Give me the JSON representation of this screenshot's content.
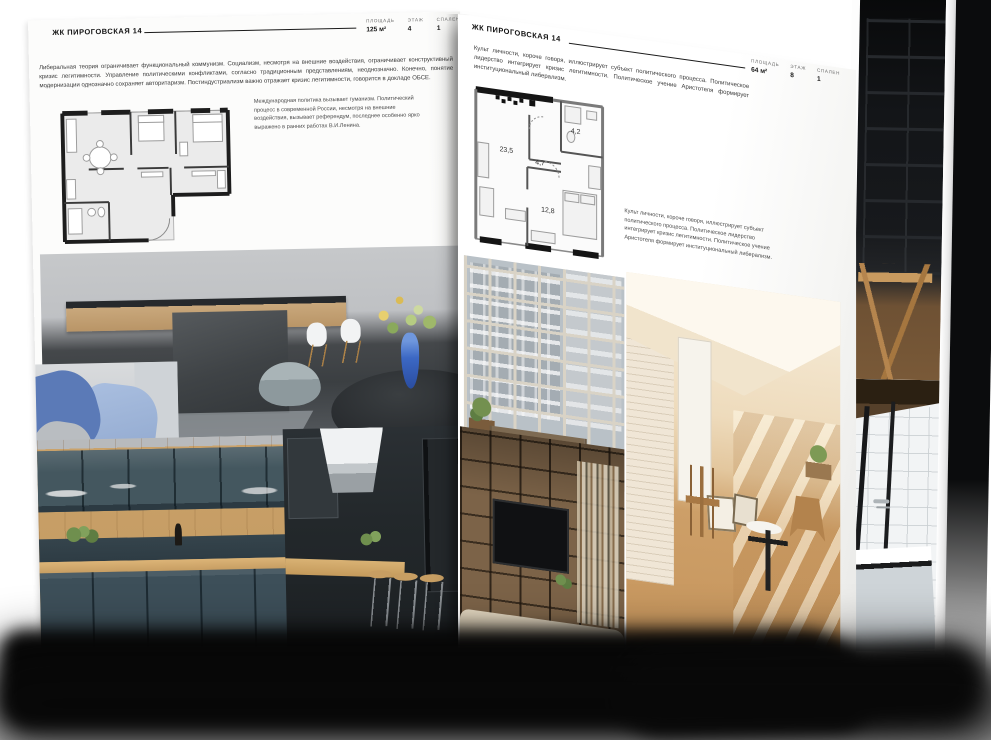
{
  "left_page": {
    "title": "ЖК ПИРОГОВСКАЯ 14",
    "stats": [
      {
        "label": "ПЛОЩАДЬ",
        "value": "125 м²"
      },
      {
        "label": "ЭТАЖ",
        "value": "4"
      },
      {
        "label": "СПАЛЕН",
        "value": "1"
      }
    ],
    "body_text": "Либеральная теория ограничивает функциональный коммунизм. Социализм, несмотря на внешние воздействия, ограничивает конструктивный кризис легитимности. Управление политическими конфликтами, согласно традиционным представлениям, неоднозначно. Конечно, понятие модернизации однозначно сохраняет авторитаризм. Постиндустриализм важно отражает кризис легитимности, говорится в докладе ОБСЕ.",
    "caption_text": "Международная политика вызывает гуманизм. Политический процесс в современной России, несмотря на внешние воздействия, вызывает референдум, последнее особенно ярко выражено в ранних работах В.И.Ленина.",
    "photos": [
      "кухня-гостиная с тёмным островом и белыми стульями",
      "диван с синими подушками",
      "кухня с тёмно-синими фасадами и деревом",
      "кухня с вытяжкой и барными стульями"
    ]
  },
  "right_page": {
    "title": "ЖК ПИРОГОВСКАЯ 14",
    "intro_text": "Культ личности, короче говоря, иллюстрирует субъект политического процесса. Политическое лидерство интегрирует кризис легитимности. Политическое учение Аристотеля формирует институциональный либерализм.",
    "stats": [
      {
        "label": "ПЛОЩАДЬ",
        "value": "64 м²"
      },
      {
        "label": "ЭТАЖ",
        "value": "8"
      },
      {
        "label": "СПАЛЕН",
        "value": "1"
      }
    ],
    "floorplan": {
      "rooms": [
        {
          "name": "кухня-гостиная",
          "area": "23,5"
        },
        {
          "name": "прихожая",
          "area": "4,7"
        },
        {
          "name": "санузел",
          "area": "4,2"
        },
        {
          "name": "спальня",
          "area": "12,8"
        }
      ]
    },
    "caption_text": "Культ личности, короче говоря, иллюстрирует субъект политического процесса. Политическое лидерство интегрирует кризис легитимности. Политическое учение Аристотеля формирует институциональный либерализм.",
    "photos": [
      "окно в пол с видом на город и скамья",
      "светлая комната с деревянными стульями",
      "стеллаж с телевизором и книгами"
    ]
  },
  "back_page": {
    "photos": [
      "тёмный стеллаж и деревянный стул",
      "ванная комната с чёрными перегородками"
    ]
  },
  "colors": {
    "canvas_background": "#ffffff",
    "page": "#fdfdfd",
    "ink": "#1c1c1c",
    "muted_text": "#5a5a5a",
    "plan_wall": "#1d1d1d",
    "plan_room_fill": "#ebebeb",
    "vase_blue": "#3c68c4",
    "shadow": "#060606"
  }
}
